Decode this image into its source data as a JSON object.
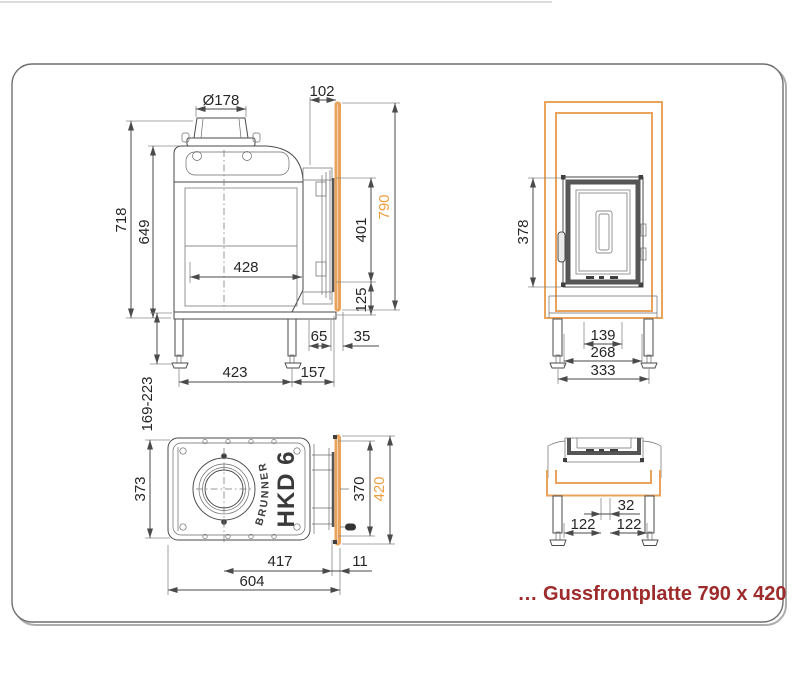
{
  "note": "… Gussfrontplatte 790 x 420",
  "colors": {
    "accent_orange_line": "#e8a35c",
    "accent_orange_text": "#ee9e40",
    "note_red": "#9e2b2b",
    "drawing_line": "#4a4a4a",
    "panel_border": "#777777"
  },
  "labels": {
    "brand": "BRUNNER",
    "model": "HKD 6"
  },
  "dims": {
    "side": {
      "d178": "Ø178",
      "d102": "102",
      "d718": "718",
      "d649": "649",
      "d428": "428",
      "d401": "401",
      "d125": "125",
      "d790": "790",
      "d65": "65",
      "d35": "35",
      "d423": "423",
      "d157": "157",
      "d169": "169-223"
    },
    "front": {
      "d378": "378",
      "d139": "139",
      "d268": "268",
      "d333": "333"
    },
    "top": {
      "d373": "373",
      "d370": "370",
      "d420": "420",
      "d417": "417",
      "d11": "11",
      "d604": "604"
    },
    "bottom": {
      "d32": "32",
      "d122_left": "122",
      "d122_right": "122"
    }
  }
}
